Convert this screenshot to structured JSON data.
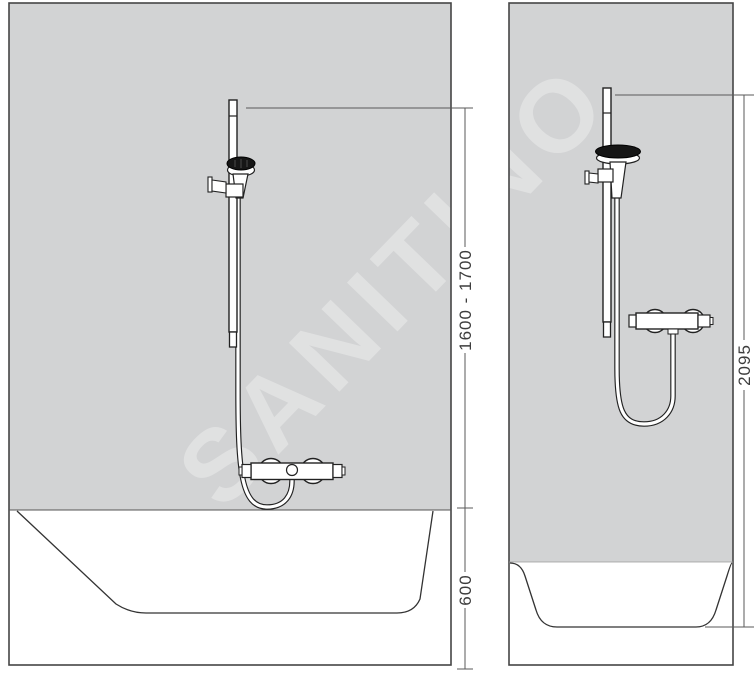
{
  "watermark": {
    "text": "SANITINO",
    "color": "#ffffff",
    "opacity": 0.32
  },
  "colors": {
    "wall": "#d2d3d4",
    "line": "#2b2b2b",
    "fixture_fill": "#ffffff",
    "shower_head_face": "#161616",
    "dimension_line": "#5a5a5a",
    "dimension_text": "#3d3d3d",
    "background": "#ffffff"
  },
  "views": {
    "front": {
      "dimensions": {
        "rail_mount_height": {
          "label": "1600 - 1700"
        },
        "tub_height": {
          "label": "600"
        }
      }
    },
    "side": {
      "dimensions": {
        "total_height": {
          "label": "2095"
        }
      }
    }
  }
}
